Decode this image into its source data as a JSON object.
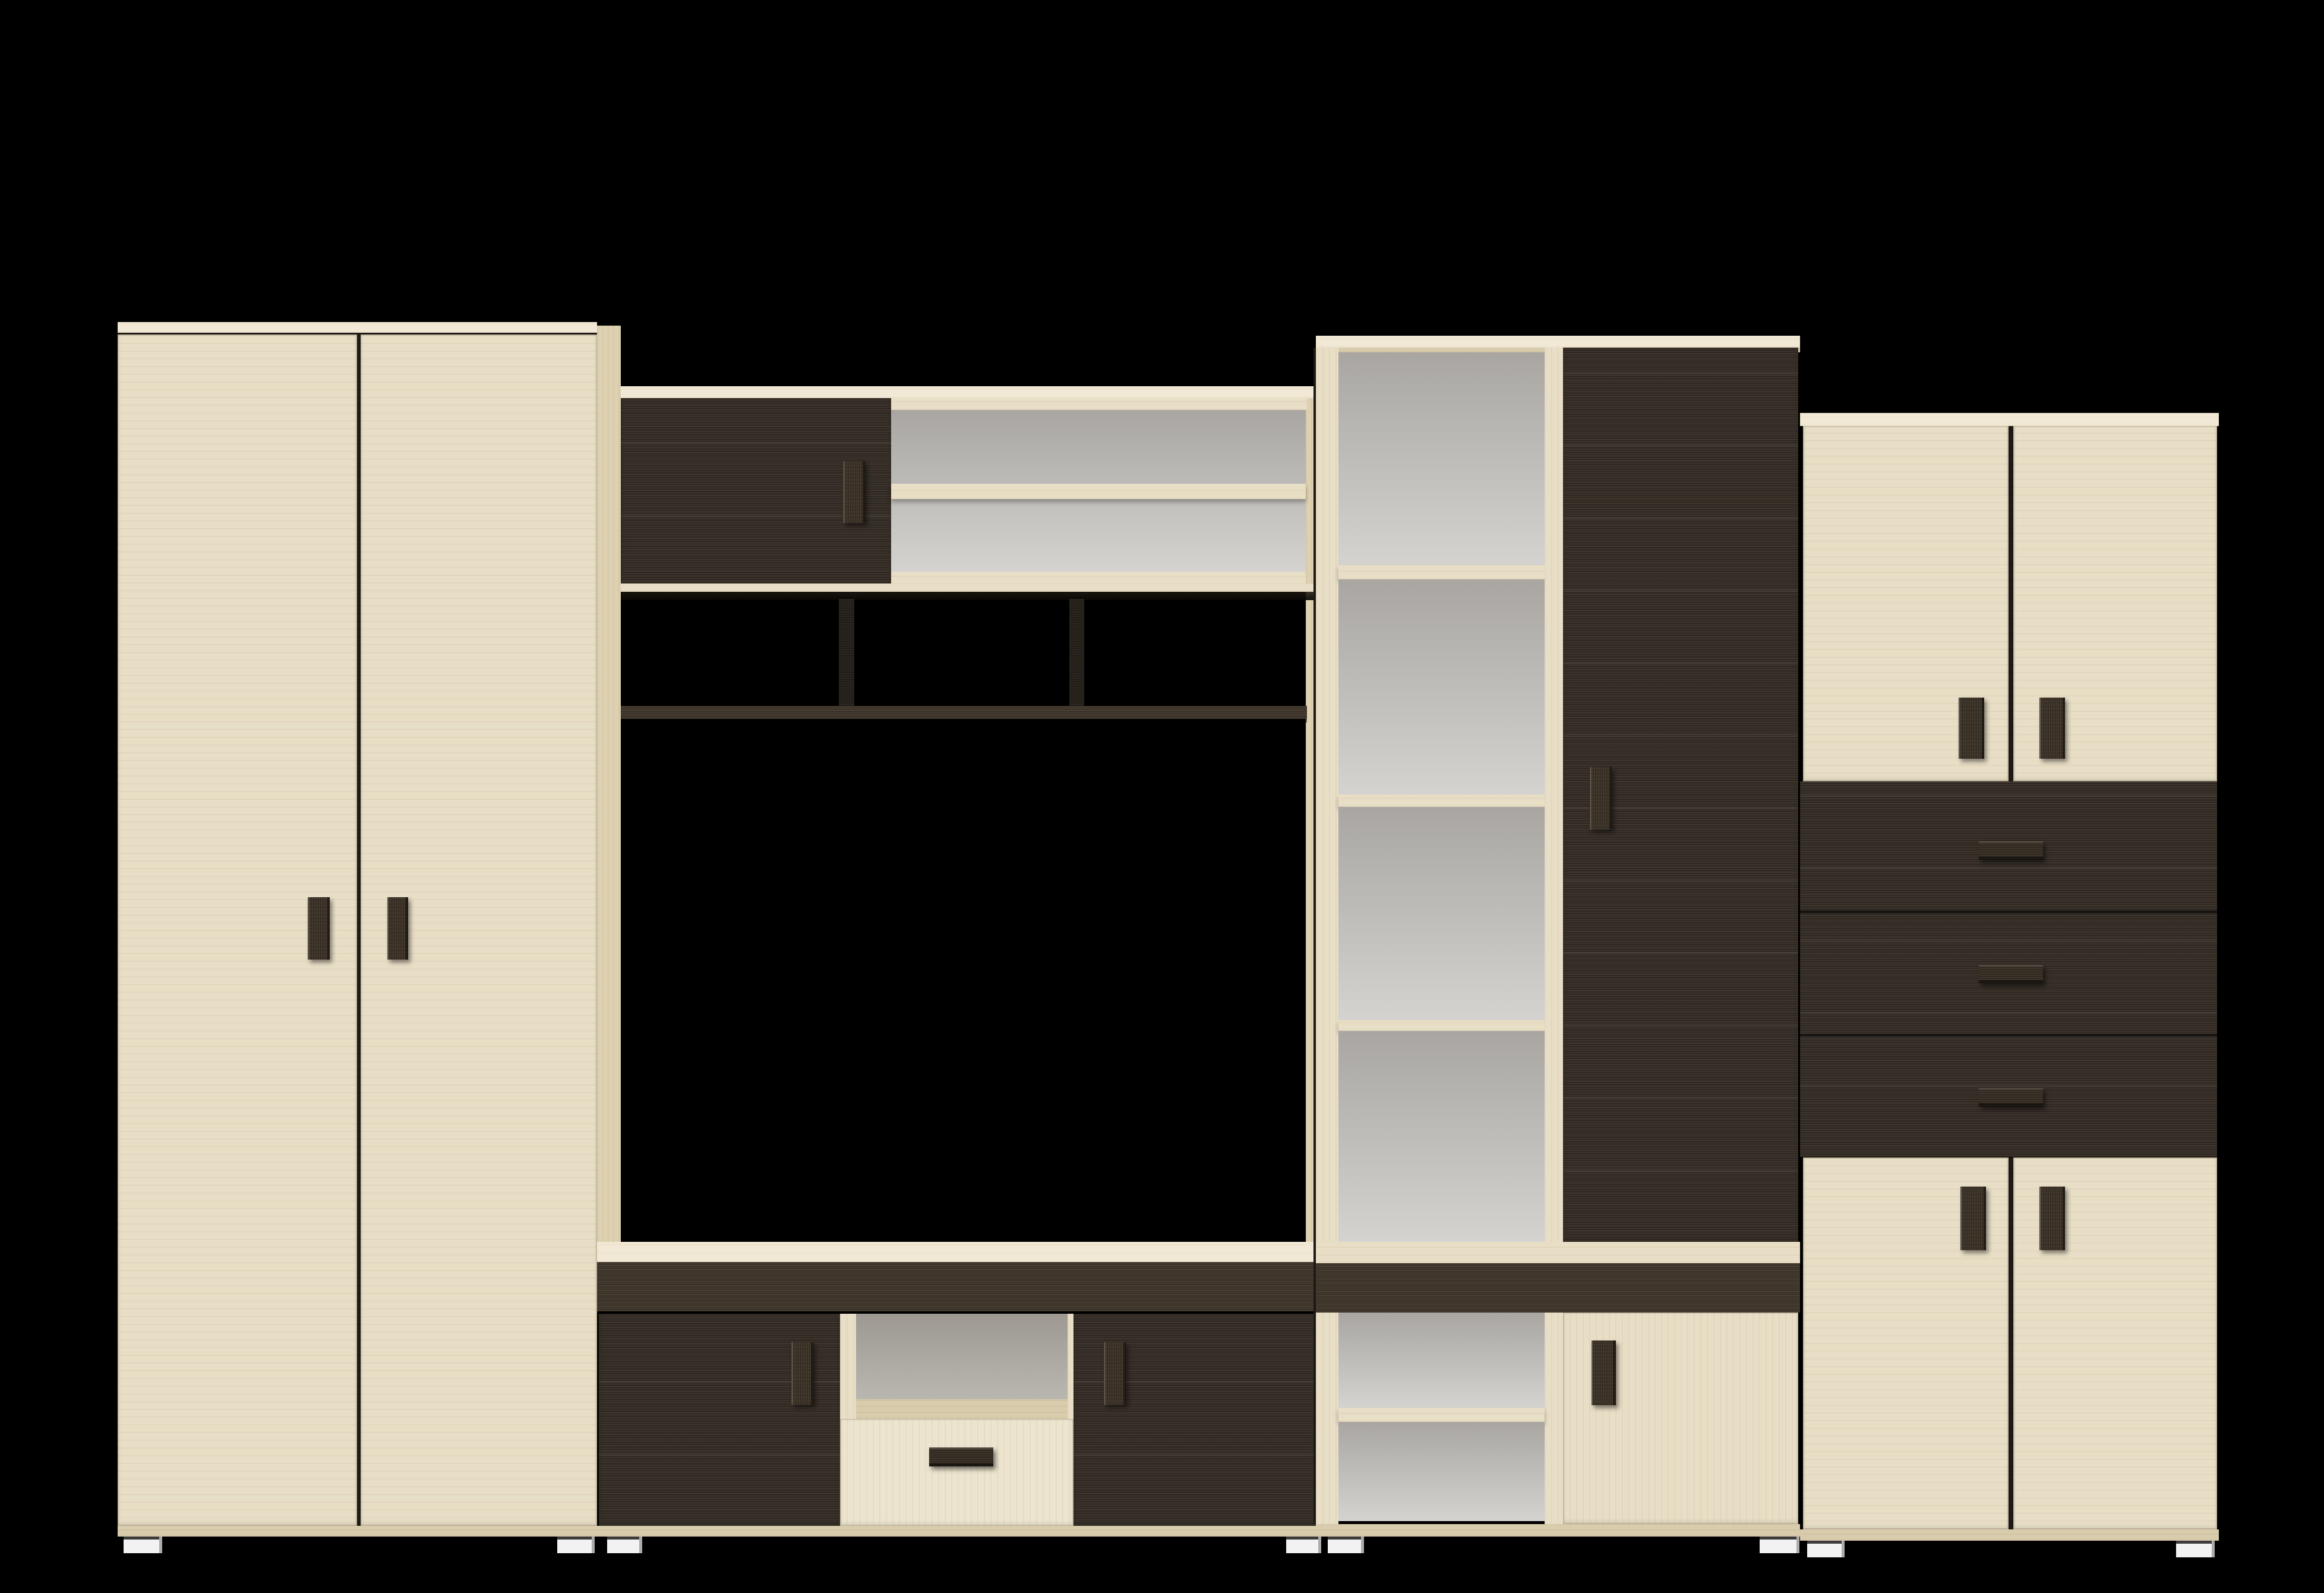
{
  "scene": {
    "description": "3D product render of a modular living-room wall unit set on a black background",
    "background": "#000000",
    "units_count": 4
  },
  "palette": {
    "bg": "#000000",
    "wood_light": "#e8dec6",
    "wood_light_bright": "#f1e9d5",
    "wood_light_dim": "#d8ccad",
    "wood_side": "#ddd1b2",
    "drawer_light": "#ece4cf",
    "wenge": "#39312a",
    "wenge_band": "#453b30",
    "wenge_dark": "#2a241e",
    "back_top": "#a9a6a2",
    "back_bottom": "#d4d3d0",
    "gap": "#1d1914",
    "foot_white": "#f2f2f2",
    "foot_shade": "#ababab"
  },
  "units": {
    "wardrobe": {
      "label": "two-door wardrobe, light maple",
      "doors": 2,
      "handles": "dark vertical bars at center"
    },
    "tv_wall": {
      "label": "TV wall section",
      "upper": "dark sliding door + open shelf with grey back",
      "middle": "three open niches over dark shelf board, open TV niche below",
      "stand": "TV stand: two dark doors, open niche and light drawer in middle"
    },
    "shelf_tower": {
      "label": "tall shelf tower",
      "left": "open shelf column with grey back, 6 compartments",
      "right": "tall dark door, light door below",
      "band": "dark horizontal band near bottom"
    },
    "side_cabinet": {
      "label": "right cabinet",
      "top": "two light doors",
      "middle": "three dark drawers with horizontal handles",
      "bottom": "two light doors"
    },
    "feet": "small white plastic feet under all units"
  }
}
